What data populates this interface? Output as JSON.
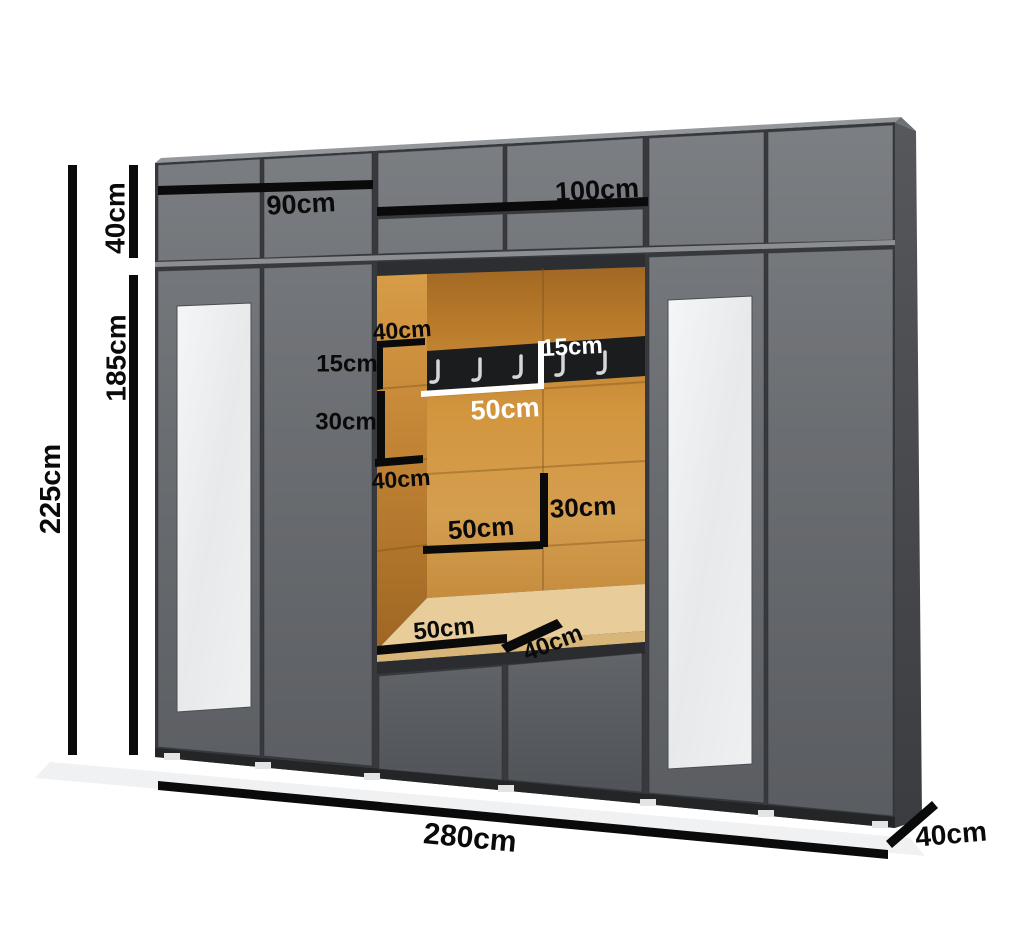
{
  "diagram": {
    "subject": "hallway-wardrobe-dimension-diagram",
    "coat_hook_count": 5
  },
  "labels": {
    "total_height": "225cm",
    "upper_cabinet_height": "40cm",
    "main_cabinet_height": "185cm",
    "left_section_width": "90cm",
    "center_section_width": "100cm",
    "total_width": "280cm",
    "cabinet_depth": "40cm",
    "niche_top_shelf_depth": "40cm",
    "niche_shelf_spacing_small": "15cm",
    "niche_shelf_spacing_large": "30cm",
    "niche_mid_shelf_depth": "40cm",
    "coat_rack_height": "15cm",
    "coat_rack_width": "50cm",
    "niche_panel_width": "50cm",
    "niche_panel_height": "30cm",
    "bench_width": "50cm",
    "bench_depth": "40cm"
  },
  "colors": {
    "background": "#ffffff",
    "door_gray": "#6a6d71",
    "drawer_gray": "#5a5d61",
    "frame_dark": "#37393d",
    "plinth_dark": "#232527",
    "side_panel": "#46484c",
    "top_sliver": "#94979b",
    "niche_orange": "#c9862f",
    "niche_orange_dark": "#9c6522",
    "bench_tan": "#e8cd9a",
    "rack_black": "#1b1c1e",
    "hook_gray": "#d4d6d8",
    "mirror_white": "#edeff1",
    "dimension_black": "#0a0a0b",
    "dimension_white": "#ffffff"
  }
}
